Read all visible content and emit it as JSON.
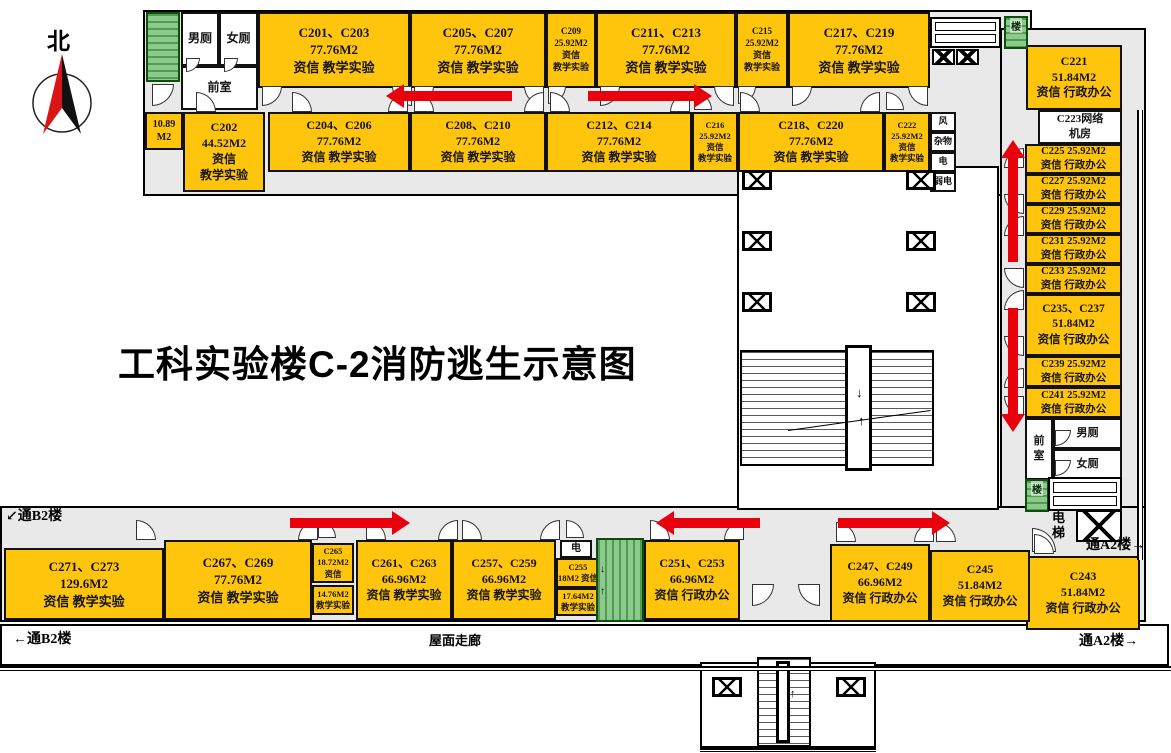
{
  "title": "工科实验楼C-2消防逃生示意图",
  "compass": {
    "label": "北"
  },
  "colors": {
    "room_yellow": "#FFC40C",
    "stair_green": "#8cc98c",
    "corridor_gray": "#E9E9E9",
    "arrow_red": "#E8000D",
    "wall_black": "#000000",
    "compass_red": "#D91616"
  },
  "panels": [
    {
      "id": "top-wing",
      "x": 143,
      "y": 10,
      "w": 889,
      "h": 186,
      "bg": "#E9E9E9"
    },
    {
      "id": "right-wing",
      "x": 1000,
      "y": 28,
      "w": 146,
      "h": 532,
      "bg": "#E9E9E9"
    },
    {
      "id": "bottom-wing",
      "x": 0,
      "y": 506,
      "w": 1146,
      "h": 116,
      "bg": "#E9E9E9"
    },
    {
      "id": "roof-corridor",
      "x": 0,
      "y": 624,
      "w": 1169,
      "h": 42,
      "bg": "#ffffff",
      "grid": true
    },
    {
      "id": "courtyard",
      "x": 737,
      "y": 166,
      "w": 262,
      "h": 344,
      "bg": "#ffffff"
    },
    {
      "id": "south-stub",
      "x": 700,
      "y": 662,
      "w": 176,
      "h": 86,
      "bg": "#ffffff"
    }
  ],
  "rooms": [
    {
      "id": "c201-c203",
      "x": 258,
      "y": 12,
      "w": 152,
      "h": 76,
      "fill": "y",
      "fs": 13,
      "lines": [
        "C201、C203",
        "77.76M2",
        "资信 教学实验"
      ]
    },
    {
      "id": "c205-c207",
      "x": 410,
      "y": 12,
      "w": 136,
      "h": 76,
      "fill": "y",
      "fs": 13,
      "lines": [
        "C205、C207",
        "77.76M2",
        "资信 教学实验"
      ]
    },
    {
      "id": "c209",
      "x": 546,
      "y": 12,
      "w": 50,
      "h": 76,
      "fill": "y",
      "fs": 9,
      "lines": [
        "C209",
        "25.92M2",
        "资信",
        "教学实验"
      ]
    },
    {
      "id": "c211-c213",
      "x": 596,
      "y": 12,
      "w": 140,
      "h": 76,
      "fill": "y",
      "fs": 13,
      "lines": [
        "C211、C213",
        "77.76M2",
        "资信 教学实验"
      ]
    },
    {
      "id": "c215",
      "x": 736,
      "y": 12,
      "w": 52,
      "h": 76,
      "fill": "y",
      "fs": 9,
      "lines": [
        "C215",
        "25.92M2",
        "资信",
        "教学实验"
      ]
    },
    {
      "id": "c217-c219",
      "x": 788,
      "y": 12,
      "w": 142,
      "h": 76,
      "fill": "y",
      "fs": 13,
      "lines": [
        "C217、C219",
        "77.76M2",
        "资信 教学实验"
      ]
    },
    {
      "id": "wc-men-nw",
      "x": 181,
      "y": 12,
      "w": 38,
      "h": 54,
      "fill": "w",
      "fs": 12,
      "lines": [
        "男厕"
      ]
    },
    {
      "id": "wc-women-nw",
      "x": 219,
      "y": 12,
      "w": 39,
      "h": 54,
      "fill": "w",
      "fs": 12,
      "lines": [
        "女厕"
      ]
    },
    {
      "id": "vestibule-nw",
      "x": 181,
      "y": 66,
      "w": 77,
      "h": 44,
      "fill": "w",
      "fs": 12,
      "lines": [
        "前室"
      ]
    },
    {
      "id": "room-10-89",
      "x": 145,
      "y": 112,
      "w": 38,
      "h": 38,
      "fill": "y",
      "fs": 10,
      "lines": [
        "10.89",
        "M2"
      ]
    },
    {
      "id": "c202",
      "x": 183,
      "y": 112,
      "w": 82,
      "h": 80,
      "fill": "y",
      "fs": 12,
      "lines": [
        "C202",
        "44.52M2",
        "资信",
        "教学实验"
      ]
    },
    {
      "id": "c204-c206",
      "x": 268,
      "y": 112,
      "w": 142,
      "h": 60,
      "fill": "y",
      "fs": 12,
      "lines": [
        "C204、C206",
        "77.76M2",
        "资信 教学实验"
      ]
    },
    {
      "id": "c208-c210",
      "x": 410,
      "y": 112,
      "w": 136,
      "h": 60,
      "fill": "y",
      "fs": 12,
      "lines": [
        "C208、C210",
        "77.76M2",
        "资信 教学实验"
      ]
    },
    {
      "id": "c212-c214",
      "x": 546,
      "y": 112,
      "w": 146,
      "h": 60,
      "fill": "y",
      "fs": 12,
      "lines": [
        "C212、C214",
        "77.76M2",
        "资信 教学实验"
      ]
    },
    {
      "id": "c216",
      "x": 692,
      "y": 112,
      "w": 46,
      "h": 60,
      "fill": "y",
      "fs": 8.5,
      "lines": [
        "C216",
        "25.92M2",
        "资信",
        "教学实验"
      ]
    },
    {
      "id": "c218-c220",
      "x": 738,
      "y": 112,
      "w": 146,
      "h": 60,
      "fill": "y",
      "fs": 12,
      "lines": [
        "C218、C220",
        "77.76M2",
        "资信 教学实验"
      ]
    },
    {
      "id": "c222",
      "x": 884,
      "y": 112,
      "w": 46,
      "h": 60,
      "fill": "y",
      "fs": 8.5,
      "lines": [
        "C222",
        "25.92M2",
        "资信",
        "教学实验"
      ]
    },
    {
      "id": "svc-wind",
      "x": 930,
      "y": 112,
      "w": 26,
      "h": 20,
      "fill": "w",
      "fs": 9,
      "lines": [
        "风"
      ]
    },
    {
      "id": "svc-sundries",
      "x": 930,
      "y": 132,
      "w": 26,
      "h": 20,
      "fill": "w",
      "fs": 9,
      "lines": [
        "杂物"
      ]
    },
    {
      "id": "svc-electric",
      "x": 930,
      "y": 152,
      "w": 26,
      "h": 20,
      "fill": "w",
      "fs": 9,
      "lines": [
        "电"
      ]
    },
    {
      "id": "svc-weak-electric",
      "x": 930,
      "y": 172,
      "w": 26,
      "h": 20,
      "fill": "w",
      "fs": 9,
      "lines": [
        "弱电"
      ]
    },
    {
      "id": "c221",
      "x": 1026,
      "y": 45,
      "w": 96,
      "h": 65,
      "fill": "y",
      "fs": 12,
      "lines": [
        "C221",
        "51.84M2",
        "资信 行政办公"
      ]
    },
    {
      "id": "c223-network-room",
      "x": 1038,
      "y": 110,
      "w": 84,
      "h": 34,
      "fill": "w",
      "fs": 11,
      "lines": [
        "C223网络",
        "机房"
      ]
    },
    {
      "id": "c225",
      "x": 1025,
      "y": 144,
      "w": 97,
      "h": 30,
      "fill": "y",
      "fs": 10.5,
      "lines": [
        "C225 25.92M2",
        "资信 行政办公"
      ]
    },
    {
      "id": "c227",
      "x": 1025,
      "y": 174,
      "w": 97,
      "h": 30,
      "fill": "y",
      "fs": 10.5,
      "lines": [
        "C227 25.92M2",
        "资信 行政办公"
      ]
    },
    {
      "id": "c229",
      "x": 1025,
      "y": 204,
      "w": 97,
      "h": 30,
      "fill": "y",
      "fs": 10.5,
      "lines": [
        "C229 25.92M2",
        "资信 行政办公"
      ]
    },
    {
      "id": "c231",
      "x": 1025,
      "y": 234,
      "w": 97,
      "h": 30,
      "fill": "y",
      "fs": 10.5,
      "lines": [
        "C231 25.92M2",
        "资信 行政办公"
      ]
    },
    {
      "id": "c233",
      "x": 1025,
      "y": 264,
      "w": 97,
      "h": 30,
      "fill": "y",
      "fs": 10.5,
      "lines": [
        "C233 25.92M2",
        "资信 行政办公"
      ]
    },
    {
      "id": "c235-c237",
      "x": 1025,
      "y": 294,
      "w": 97,
      "h": 62,
      "fill": "y",
      "fs": 11.5,
      "lines": [
        "C235、C237",
        "51.84M2",
        "资信 行政办公"
      ]
    },
    {
      "id": "c239",
      "x": 1025,
      "y": 356,
      "w": 97,
      "h": 31,
      "fill": "y",
      "fs": 10.5,
      "lines": [
        "C239 25.92M2",
        "资信 行政办公"
      ]
    },
    {
      "id": "c241",
      "x": 1025,
      "y": 387,
      "w": 97,
      "h": 31,
      "fill": "y",
      "fs": 10.5,
      "lines": [
        "C241 25.92M2",
        "资信 行政办公"
      ]
    },
    {
      "id": "vestibule-se",
      "x": 1025,
      "y": 418,
      "w": 28,
      "h": 62,
      "fill": "w",
      "fs": 11,
      "lines": [
        "前",
        "室"
      ]
    },
    {
      "id": "wc-men-se",
      "x": 1053,
      "y": 418,
      "w": 69,
      "h": 31,
      "fill": "w",
      "fs": 11,
      "lines": [
        "男厕"
      ]
    },
    {
      "id": "wc-women-se",
      "x": 1053,
      "y": 449,
      "w": 69,
      "h": 31,
      "fill": "w",
      "fs": 11,
      "lines": [
        "女厕"
      ]
    },
    {
      "id": "c243",
      "x": 1026,
      "y": 556,
      "w": 114,
      "h": 74,
      "fill": "y",
      "fs": 12,
      "lines": [
        "C243",
        "51.84M2",
        "资信 行政办公"
      ]
    },
    {
      "id": "c271-c273",
      "x": 4,
      "y": 548,
      "w": 160,
      "h": 72,
      "fill": "y",
      "fs": 13,
      "lines": [
        "C271、C273",
        "129.6M2",
        "资信 教学实验"
      ]
    },
    {
      "id": "c267-c269",
      "x": 164,
      "y": 540,
      "w": 148,
      "h": 80,
      "fill": "y",
      "fs": 13,
      "lines": [
        "C267、C269",
        "77.76M2",
        "资信 教学实验"
      ]
    },
    {
      "id": "c265",
      "x": 312,
      "y": 543,
      "w": 42,
      "h": 40,
      "fill": "y",
      "fs": 8.5,
      "lines": [
        "C265",
        "18.72M2",
        "资信"
      ]
    },
    {
      "id": "c265-south",
      "x": 312,
      "y": 585,
      "w": 42,
      "h": 30,
      "fill": "y",
      "fs": 8.5,
      "lines": [
        "14.76M2",
        "教学实验"
      ]
    },
    {
      "id": "c261-c263",
      "x": 356,
      "y": 540,
      "w": 96,
      "h": 80,
      "fill": "y",
      "fs": 12,
      "lines": [
        "C261、C263",
        "66.96M2",
        "资信 教学实验"
      ]
    },
    {
      "id": "c257-c259",
      "x": 452,
      "y": 540,
      "w": 104,
      "h": 80,
      "fill": "y",
      "fs": 12,
      "lines": [
        "C257、C259",
        "66.96M2",
        "资信 教学实验"
      ]
    },
    {
      "id": "svc-electric-south",
      "x": 560,
      "y": 540,
      "w": 32,
      "h": 18,
      "fill": "w",
      "fs": 10,
      "lines": [
        "电"
      ]
    },
    {
      "id": "c255",
      "x": 556,
      "y": 558,
      "w": 44,
      "h": 30,
      "fill": "y",
      "fs": 8.5,
      "lines": [
        "C255",
        "18M2 资信"
      ]
    },
    {
      "id": "c255-south",
      "x": 556,
      "y": 588,
      "w": 44,
      "h": 28,
      "fill": "y",
      "fs": 8.5,
      "lines": [
        "17.64M2",
        "教学实验"
      ]
    },
    {
      "id": "c251-c253",
      "x": 644,
      "y": 540,
      "w": 96,
      "h": 80,
      "fill": "y",
      "fs": 12,
      "lines": [
        "C251、C253",
        "66.96M2",
        "资信 行政办公"
      ]
    },
    {
      "id": "c247-c249",
      "x": 830,
      "y": 544,
      "w": 100,
      "h": 78,
      "fill": "y",
      "fs": 12,
      "lines": [
        "C247、C249",
        "66.96M2",
        "资信 行政办公"
      ]
    },
    {
      "id": "c245",
      "x": 930,
      "y": 550,
      "w": 100,
      "h": 72,
      "fill": "y",
      "fs": 12,
      "lines": [
        "C245",
        "51.84M2",
        "资信 行政办公"
      ]
    }
  ],
  "stairs": [
    {
      "id": "stair-northwest",
      "x": 146,
      "y": 12,
      "w": 34,
      "h": 70,
      "label": ""
    },
    {
      "id": "stair-northeast",
      "x": 1004,
      "y": 16,
      "w": 24,
      "h": 33,
      "label": "楼"
    },
    {
      "id": "stair-southeast",
      "x": 1025,
      "y": 479,
      "w": 24,
      "h": 33,
      "label": "楼"
    },
    {
      "id": "stair-south",
      "x": 596,
      "y": 538,
      "w": 48,
      "h": 84,
      "vert": true,
      "label": ""
    }
  ],
  "staircases": [
    {
      "id": "staircase-central",
      "x": 740,
      "y": 350,
      "w": 194,
      "h": 116,
      "spine": {
        "x": 845,
        "y": 345,
        "w": 27,
        "h": 126
      },
      "diag": {
        "x": 788,
        "y": 430,
        "len": 144,
        "rot": -8
      }
    },
    {
      "id": "staircase-stub",
      "x": 757,
      "y": 657,
      "w": 54,
      "h": 90,
      "spine": {
        "x": 776,
        "y": 661,
        "w": 14,
        "h": 82
      }
    }
  ],
  "slots": [
    {
      "id": "slots-north",
      "x": 930,
      "y": 17,
      "w": 71,
      "h": 31
    },
    {
      "id": "slots-southeast",
      "x": 1048,
      "y": 477,
      "w": 74,
      "h": 34
    }
  ],
  "hatches": [
    {
      "id": "elevator-hatch-n1",
      "x": 932,
      "y": 49,
      "w": 23,
      "h": 16
    },
    {
      "id": "elevator-hatch-n2",
      "x": 956,
      "y": 49,
      "w": 23,
      "h": 16
    },
    {
      "id": "elevator-hatch-se",
      "x": 1076,
      "y": 510,
      "w": 46,
      "h": 32
    }
  ],
  "columns": [
    [
      742,
      170
    ],
    [
      906,
      170
    ],
    [
      742,
      231
    ],
    [
      906,
      231
    ],
    [
      742,
      292
    ],
    [
      906,
      292
    ],
    [
      712,
      677
    ],
    [
      836,
      677
    ]
  ],
  "walls": [
    {
      "id": "wall-right-double",
      "x": 1137,
      "y": 110,
      "w": 6,
      "h": 450,
      "type": "v"
    },
    {
      "id": "wall-roof-south",
      "x": 0,
      "y": 666,
      "w": 1171,
      "h": 5,
      "type": "h"
    },
    {
      "id": "wall-stub-south",
      "x": 700,
      "y": 748,
      "w": 176,
      "h": 4,
      "type": "h"
    }
  ],
  "doors": [
    [
      152,
      84,
      22,
      "se"
    ],
    [
      186,
      58,
      14,
      "se"
    ],
    [
      224,
      58,
      14,
      "se"
    ],
    [
      262,
      86,
      20,
      "se"
    ],
    [
      392,
      86,
      20,
      "sw"
    ],
    [
      414,
      86,
      20,
      "se"
    ],
    [
      524,
      86,
      20,
      "sw"
    ],
    [
      548,
      86,
      18,
      "se"
    ],
    [
      600,
      86,
      20,
      "se"
    ],
    [
      714,
      86,
      20,
      "sw"
    ],
    [
      738,
      86,
      18,
      "se"
    ],
    [
      792,
      86,
      20,
      "se"
    ],
    [
      908,
      86,
      20,
      "sw"
    ],
    [
      196,
      92,
      20,
      "ne"
    ],
    [
      292,
      92,
      20,
      "ne"
    ],
    [
      388,
      92,
      20,
      "nw"
    ],
    [
      414,
      92,
      20,
      "ne"
    ],
    [
      524,
      92,
      20,
      "nw"
    ],
    [
      550,
      92,
      20,
      "ne"
    ],
    [
      670,
      92,
      20,
      "nw"
    ],
    [
      694,
      92,
      18,
      "ne"
    ],
    [
      740,
      92,
      20,
      "ne"
    ],
    [
      860,
      92,
      20,
      "nw"
    ],
    [
      886,
      92,
      18,
      "ne"
    ],
    [
      1004,
      148,
      20,
      "nw"
    ],
    [
      1004,
      194,
      20,
      "sw"
    ],
    [
      1004,
      216,
      20,
      "nw"
    ],
    [
      1004,
      268,
      20,
      "sw"
    ],
    [
      1004,
      290,
      20,
      "nw"
    ],
    [
      1004,
      336,
      20,
      "sw"
    ],
    [
      1004,
      368,
      20,
      "nw"
    ],
    [
      1004,
      396,
      20,
      "sw"
    ],
    [
      1055,
      430,
      16,
      "se"
    ],
    [
      1055,
      460,
      16,
      "se"
    ],
    [
      1032,
      528,
      24,
      "ne"
    ],
    [
      136,
      520,
      20,
      "ne"
    ],
    [
      298,
      520,
      20,
      "nw"
    ],
    [
      318,
      520,
      18,
      "ne"
    ],
    [
      366,
      520,
      20,
      "ne"
    ],
    [
      438,
      520,
      20,
      "nw"
    ],
    [
      462,
      520,
      20,
      "ne"
    ],
    [
      540,
      520,
      20,
      "nw"
    ],
    [
      566,
      520,
      18,
      "ne"
    ],
    [
      650,
      520,
      20,
      "ne"
    ],
    [
      724,
      520,
      20,
      "nw"
    ],
    [
      836,
      522,
      20,
      "ne"
    ],
    [
      914,
      522,
      20,
      "nw"
    ],
    [
      936,
      522,
      20,
      "ne"
    ],
    [
      1034,
      534,
      20,
      "ne"
    ],
    [
      752,
      584,
      22,
      "se"
    ],
    [
      798,
      584,
      22,
      "sw"
    ]
  ],
  "arrows": [
    {
      "id": "arrow-top-west",
      "dir": "left",
      "x": 386,
      "y": 96,
      "len": 126
    },
    {
      "id": "arrow-top-east",
      "dir": "right",
      "x": 712,
      "y": 96,
      "len": 124
    },
    {
      "id": "arrow-right-up",
      "dir": "up",
      "x": 1013,
      "y": 140,
      "len": 122
    },
    {
      "id": "arrow-right-down",
      "dir": "down",
      "x": 1013,
      "y": 432,
      "len": 124
    },
    {
      "id": "arrow-bottom-west",
      "dir": "right",
      "x": 410,
      "y": 523,
      "len": 120
    },
    {
      "id": "arrow-bottom-center",
      "dir": "left",
      "x": 656,
      "y": 523,
      "len": 104
    },
    {
      "id": "arrow-bottom-east",
      "dir": "right",
      "x": 950,
      "y": 523,
      "len": 112
    }
  ],
  "labels": [
    {
      "id": "label-to-b2-upper",
      "x": 6,
      "y": 509,
      "fs": 14,
      "text": "↙通B2楼"
    },
    {
      "id": "label-to-b2-lower",
      "x": 10,
      "y": 632,
      "fs": 14,
      "text": "←通B2楼",
      "bg": true
    },
    {
      "id": "label-roof-corridor",
      "x": 426,
      "y": 634,
      "fs": 13,
      "text": "屋面走廊",
      "bg": true
    },
    {
      "id": "label-to-a2-lower",
      "x": 1076,
      "y": 634,
      "fs": 14,
      "text": "通A2楼→",
      "bg": true
    },
    {
      "id": "label-to-a2-right",
      "x": 1086,
      "y": 538,
      "fs": 14,
      "text": "通A2楼→"
    },
    {
      "id": "label-elevator-se",
      "x": 1052,
      "y": 511,
      "fs": 13,
      "text": "电\n梯"
    },
    {
      "id": "label-stair-arrow-down-central",
      "x": 856,
      "y": 386,
      "fs": 13,
      "text": "↓"
    },
    {
      "id": "label-stair-arrow-up-central",
      "x": 858,
      "y": 414,
      "fs": 13,
      "text": "↑"
    },
    {
      "id": "label-stair-arrow-down-south",
      "x": 600,
      "y": 564,
      "fs": 10,
      "text": "↓"
    },
    {
      "id": "label-stair-arrow-up-south",
      "x": 600,
      "y": 586,
      "fs": 10,
      "text": "↑"
    },
    {
      "id": "label-stub-arrow",
      "x": 790,
      "y": 688,
      "fs": 11,
      "text": "↑"
    }
  ]
}
